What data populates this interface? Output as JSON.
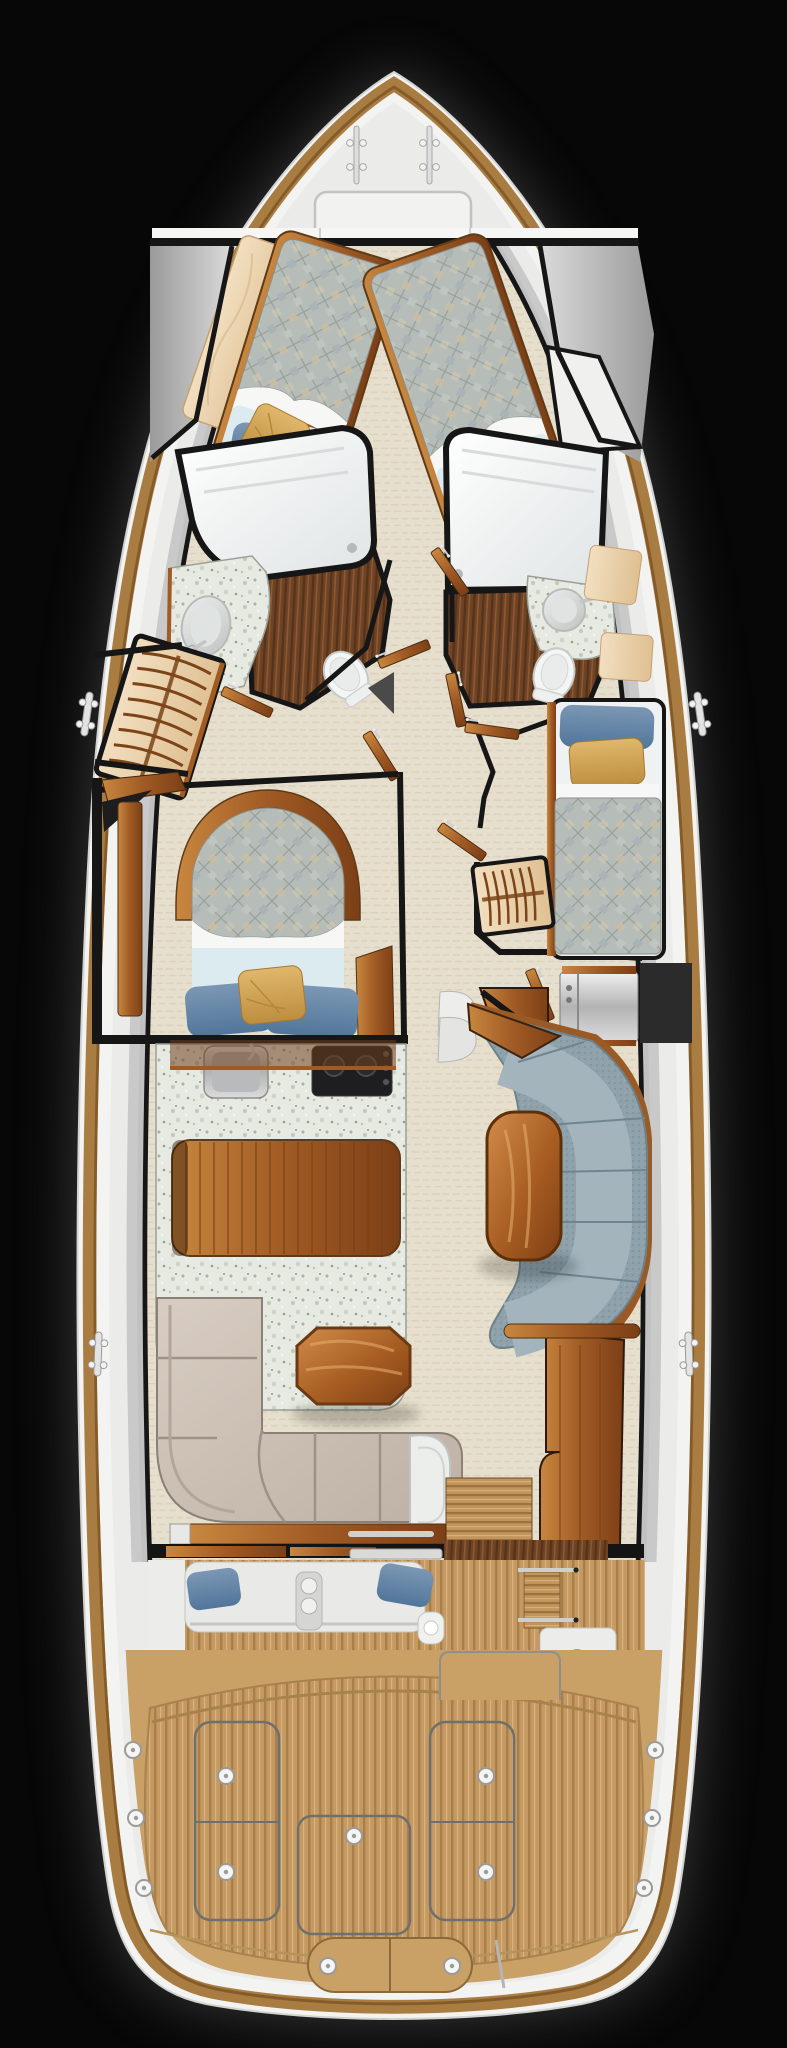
{
  "image": {
    "kind": "yacht-interior-deck-plan",
    "orientation": "bow-up",
    "visible_text": "",
    "width_px": 787,
    "height_px": 2048
  },
  "colors": {
    "background": "#070707",
    "glow": "#6f6f6f",
    "hull_white": "#f3f3f1",
    "deck_white": "#ebebe9",
    "toe_rail": "#a97c42",
    "toe_rail_dark": "#7c5423",
    "liner_grey": "#c9c9c9",
    "wall_black": "#161616",
    "carpet": "#e7dfcd",
    "teak_floor": "#6e4325",
    "cockpit_teak": "#c59a62",
    "margin_teak": "#c9a065",
    "wood_rich": "#a95f28",
    "wood_light": "#ecd5ae",
    "granite": "#e7eae2",
    "quilt": "#b6bcb8",
    "pillow_blue": "#6886a5",
    "pillow_gold": "#d2a356",
    "sheet_blue": "#dcebf0",
    "sheet_white": "#f7f8f6",
    "sofa_leather": "#c9bdb1",
    "dinette_fabric": "#8fa2ac",
    "dinette_fabric_light": "#a3b4bc",
    "appliance_silver": "#c9c9c9",
    "chrome": "#d8d8d8",
    "hatch_line": "#6f6f6f",
    "shower_white": "#f2f4f4",
    "cooktop_black": "#1e1e20"
  },
  "areas": [
    {
      "id": "foredeck"
    },
    {
      "id": "forward-v-berth-cabin"
    },
    {
      "id": "port-head"
    },
    {
      "id": "starboard-head"
    },
    {
      "id": "hanging-lockers"
    },
    {
      "id": "guest-cabin"
    },
    {
      "id": "master-stateroom"
    },
    {
      "id": "galley"
    },
    {
      "id": "dinette"
    },
    {
      "id": "salon"
    },
    {
      "id": "mezzanine-seat"
    },
    {
      "id": "cockpit"
    },
    {
      "id": "transom"
    }
  ],
  "fixtures": {
    "bow_cleats": 2,
    "side_cleats": 4,
    "deck_hatches": 3,
    "toilets": 2,
    "sinks_heads": 2,
    "showers": 2,
    "berths": 5,
    "cockpit_round_fittings": 8
  }
}
